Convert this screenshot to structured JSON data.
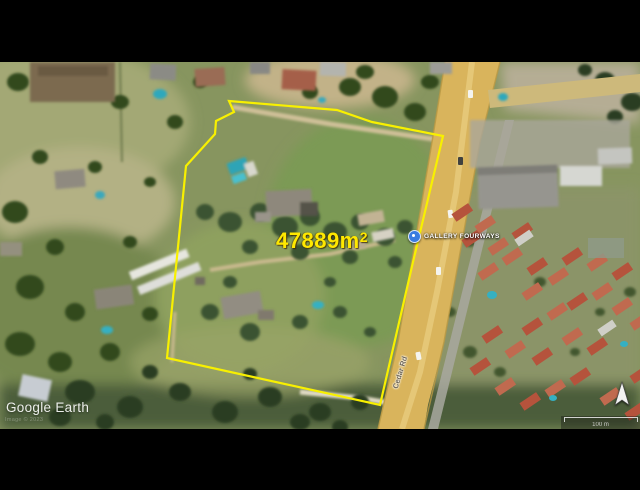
{
  "map": {
    "watermark": "Google Earth",
    "attribution": "Image © 2023",
    "area_label": {
      "value": "47889m",
      "superscript": "2"
    },
    "place": {
      "label": "GALLERY FOURWAYS"
    },
    "road_label": "Cedar Rd",
    "scale": {
      "label": "100 m"
    },
    "colors": {
      "boundary_yellow": "#f8f000",
      "area_text_yellow": "#ffe800",
      "place_icon_blue": "#3b7ce0",
      "road_yellow": "#d9b45c",
      "background_black": "#000000"
    }
  }
}
